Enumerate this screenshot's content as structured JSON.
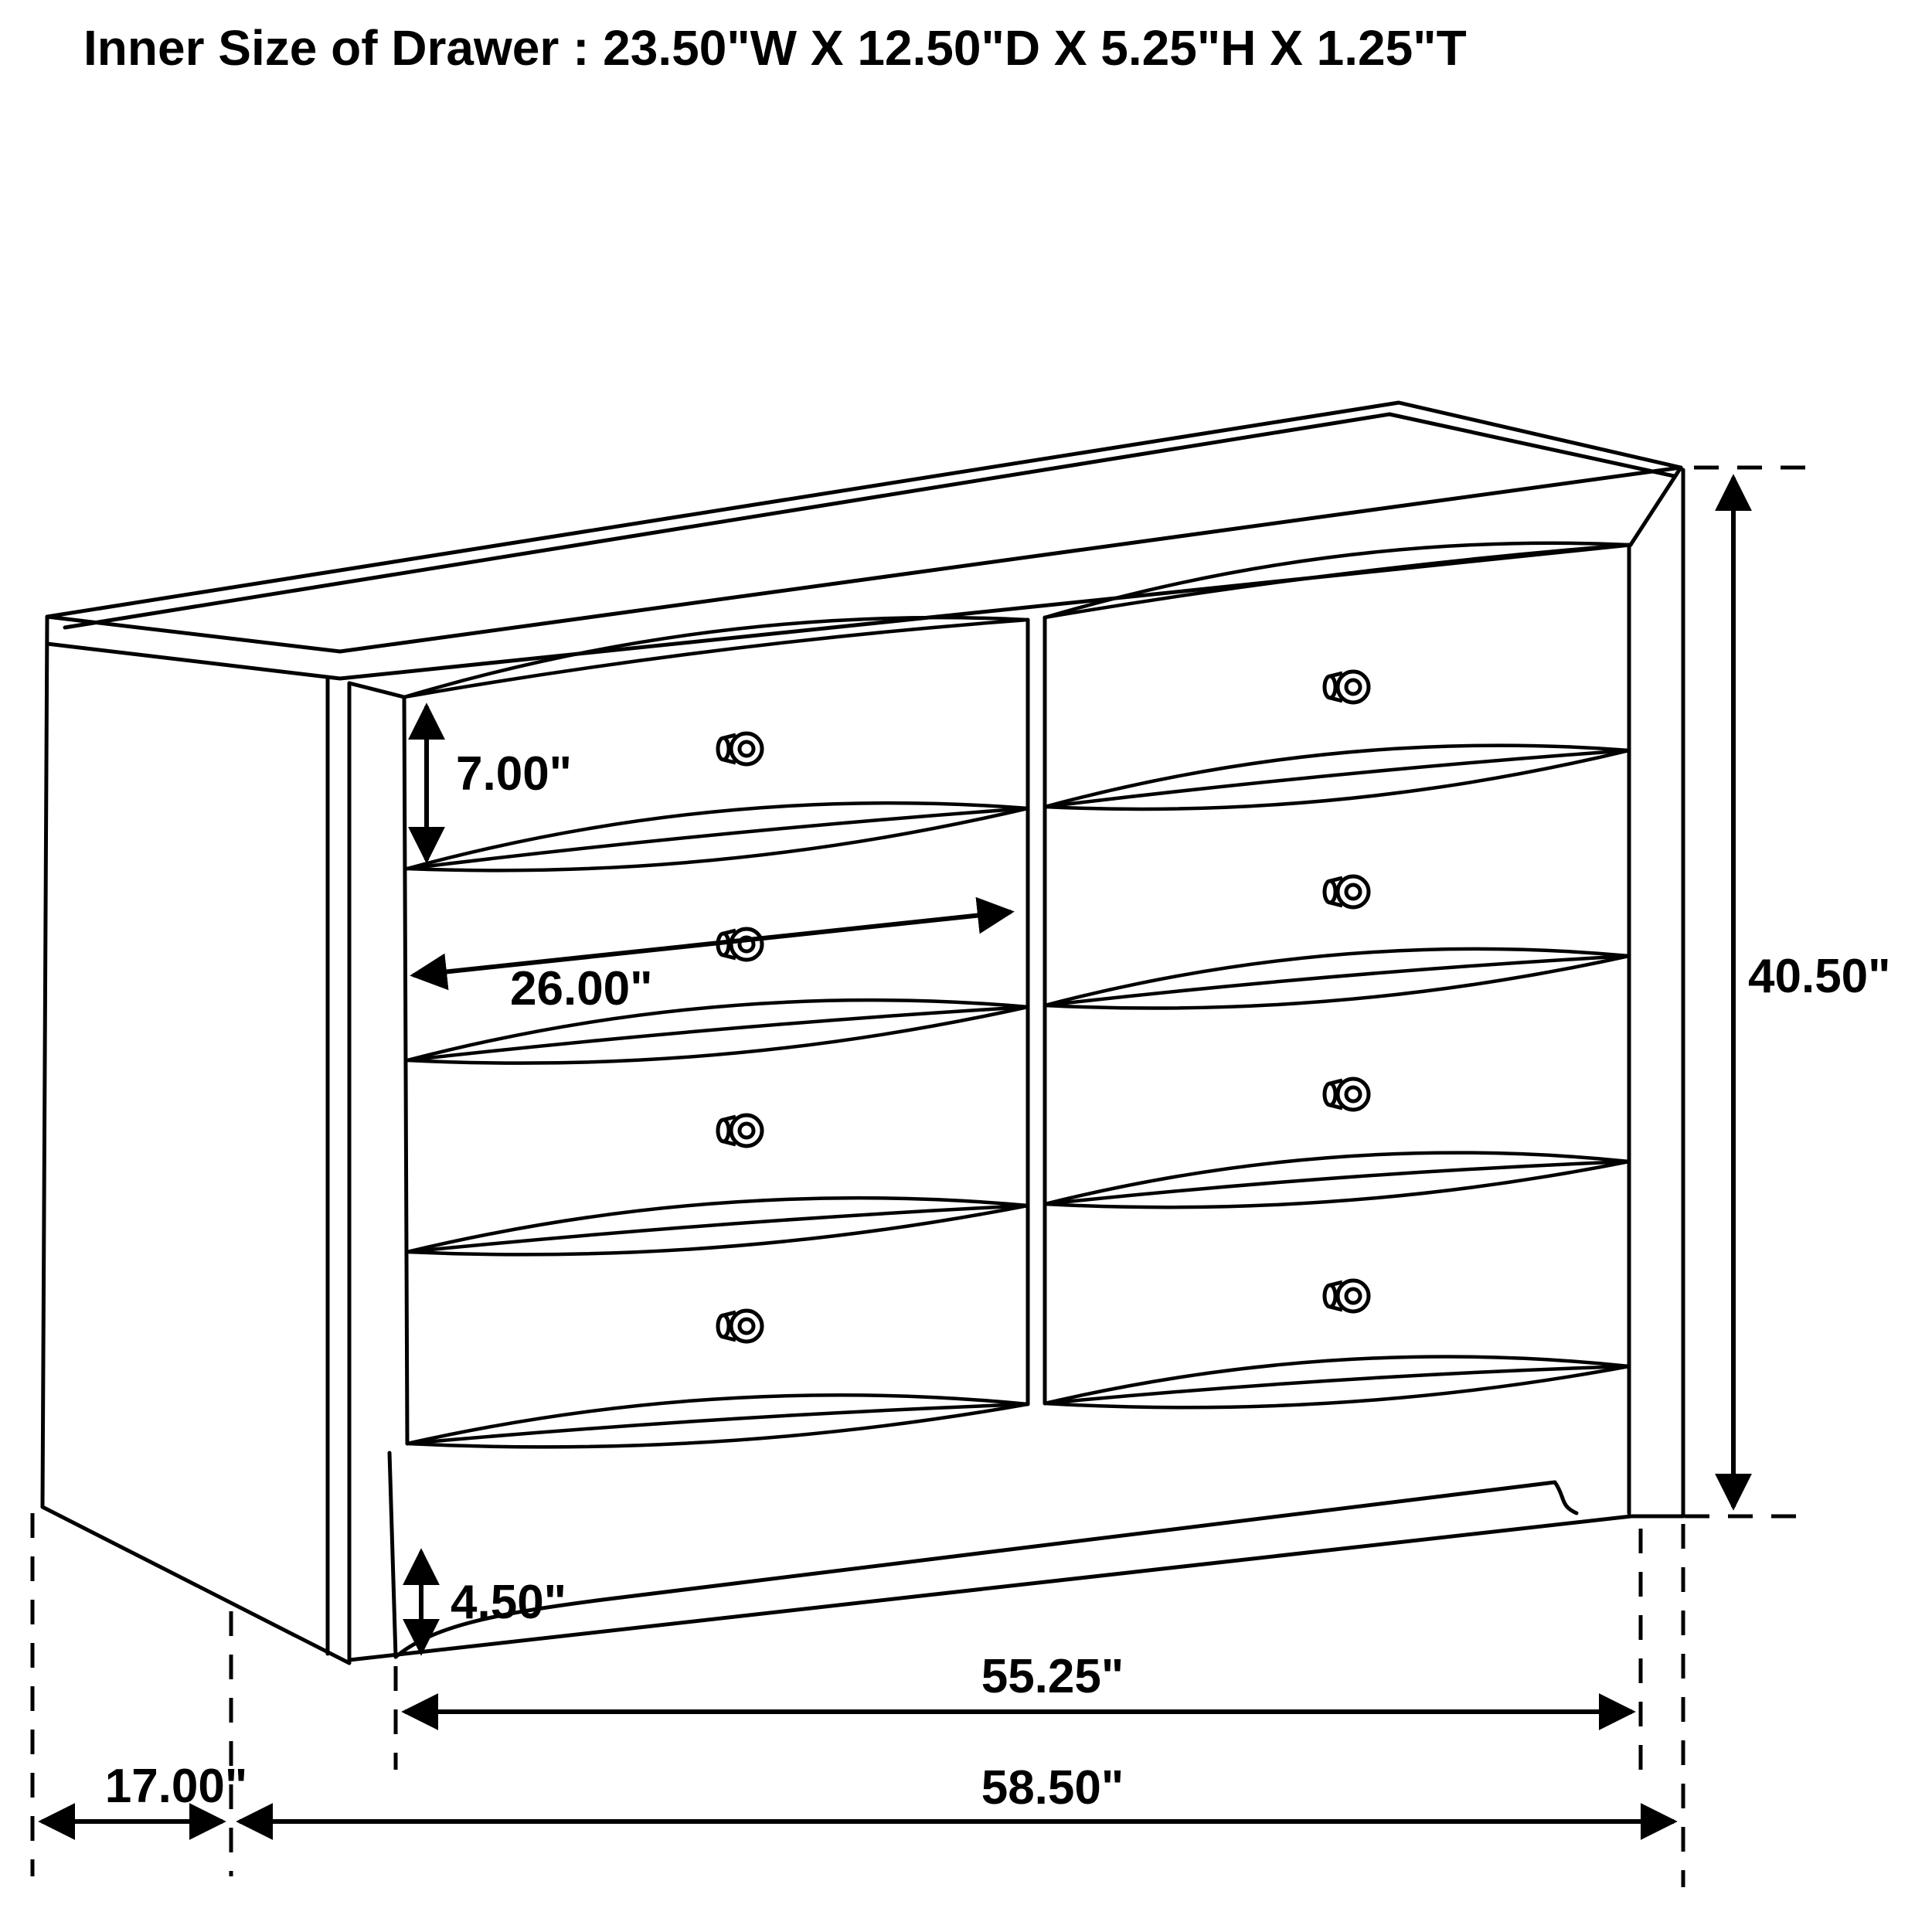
{
  "title": "Inner Size of Drawer : 23.50\"W X 12.50\"D X 5.25\"H X 1.25\"T",
  "diagram": {
    "type": "furniture-dimension-drawing",
    "subject": "six-plus-two drawer dresser, 2 columns x 4 rows, perspective line art",
    "labels": {
      "drawer_front_height": "7.00\"",
      "drawer_width": "26.00\"",
      "overall_height": "40.50\"",
      "base_foot_height": "4.50\"",
      "front_feet_span": "55.25\"",
      "side_depth": "17.00\"",
      "overall_width": "58.50\""
    },
    "colors": {
      "line": "#000000",
      "background": "#ffffff"
    }
  }
}
